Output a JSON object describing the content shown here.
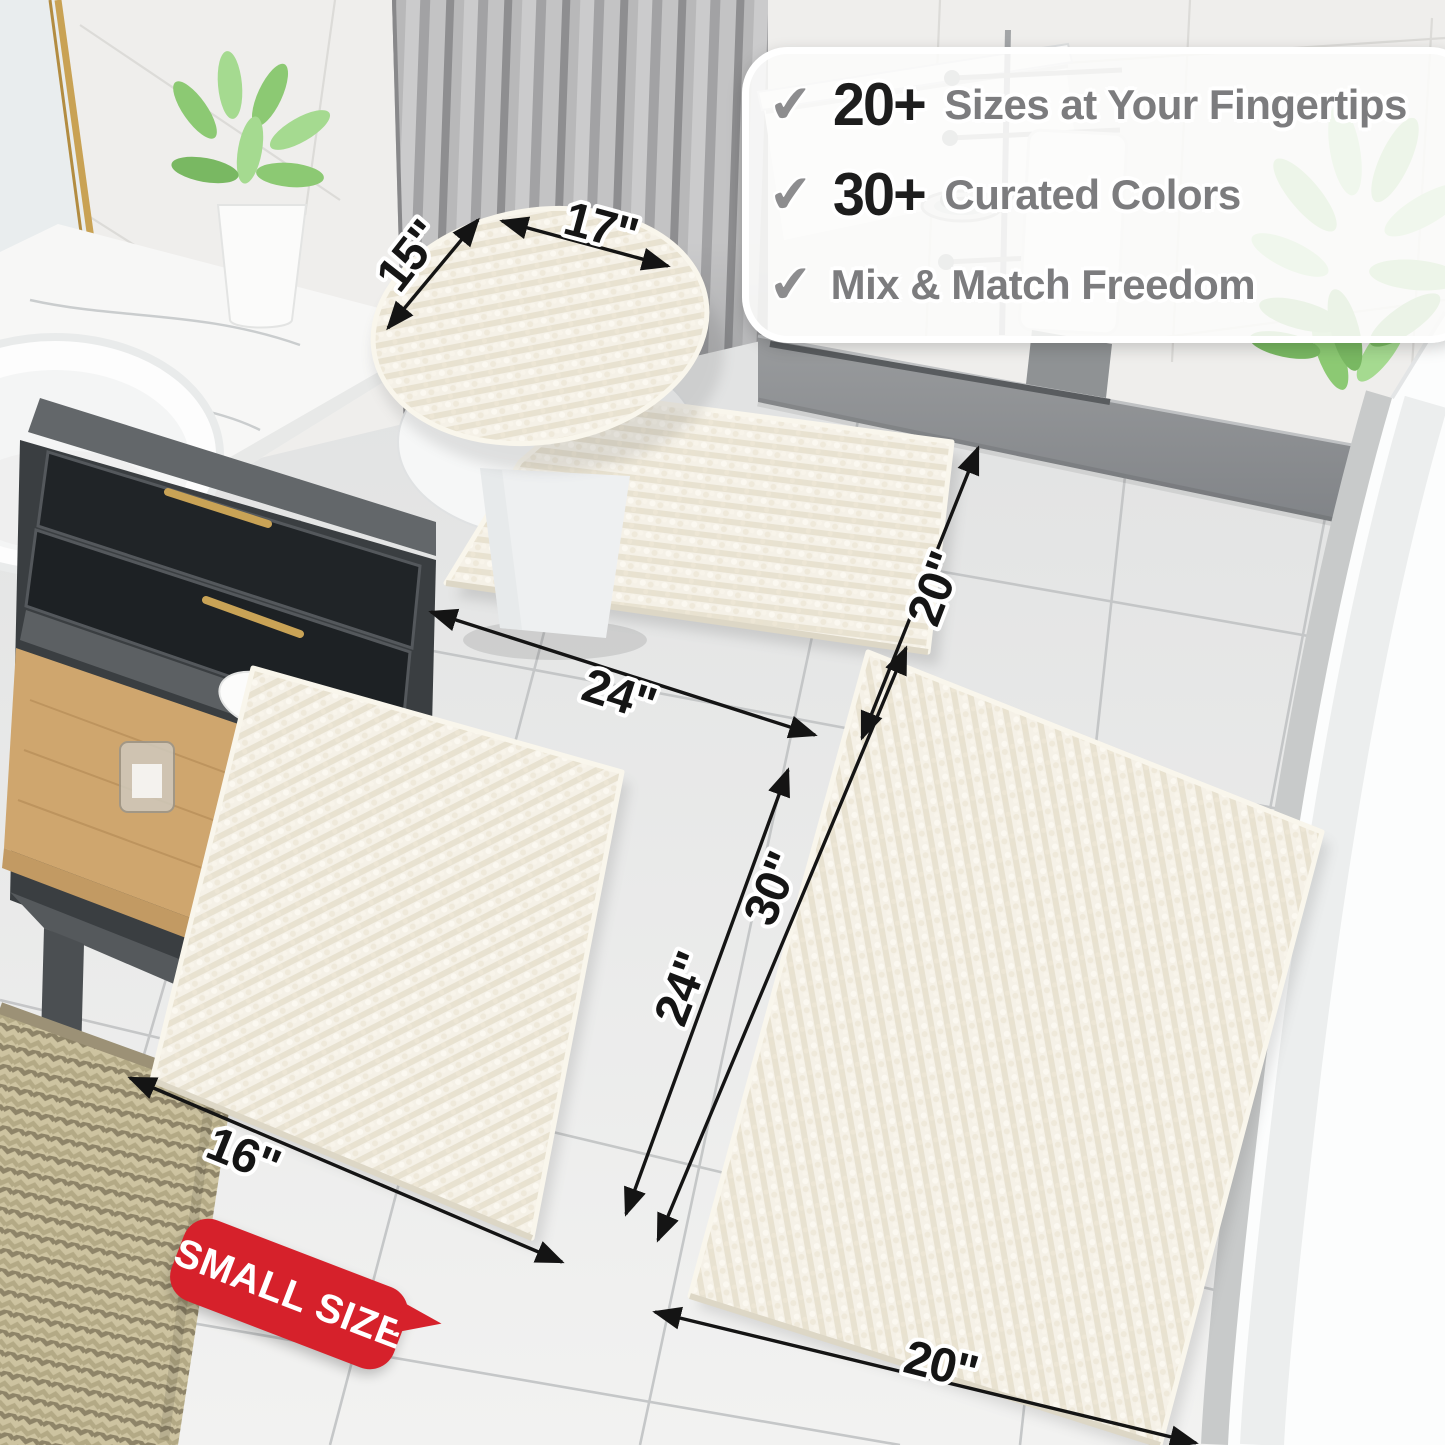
{
  "callout": {
    "check": "✔",
    "items": [
      {
        "number": "20+",
        "text": "Sizes at Your Fingertips"
      },
      {
        "number": "30+",
        "text": "Curated Colors"
      },
      {
        "number": "",
        "text": "Mix & Match Freedom"
      }
    ]
  },
  "dimensions": {
    "toilet_lid_cover": {
      "width": "17\"",
      "depth": "15\""
    },
    "contour_rug": {
      "width": "24\"",
      "depth": "20\""
    },
    "small_rug": {
      "width": "16\"",
      "length": "24\""
    },
    "large_rug": {
      "width": "20\"",
      "length": "30\""
    }
  },
  "badge": {
    "label": "SMALL SIZE"
  },
  "colors": {
    "badge_red": "#d6212b",
    "number_black": "#1d1d1d",
    "callout_gray": "#7c7c7e",
    "rug_cream": "#f5f1e7",
    "dimension_black": "#151515"
  }
}
